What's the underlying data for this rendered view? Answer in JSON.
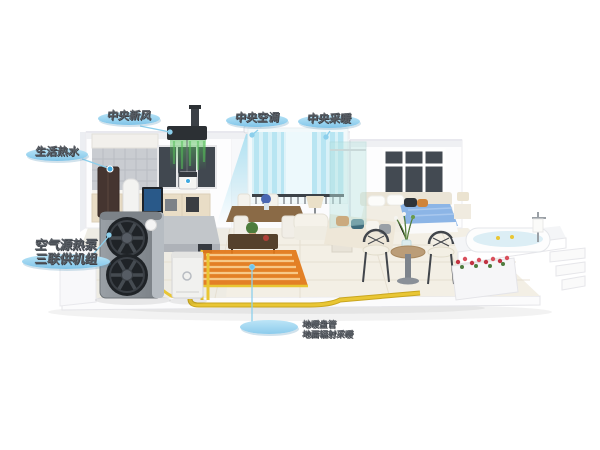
{
  "labels": {
    "fresh_air": "中央新风",
    "air_conditioning": "中央空调",
    "heating": "中央采暖",
    "hot_water": "生活热水",
    "heat_pump_line1": "空气源热泵",
    "heat_pump_line2": "三联供机组",
    "floor_heating_line1": "地暖盘管",
    "floor_heating_line2": "地面辐射采暖"
  },
  "colors": {
    "label_pill": "#92cfee",
    "label_text": "#565b62",
    "leader_line": "#8ccfec",
    "airflow_cool": "#7fd2ec",
    "airflow_fresh": "#56c05a",
    "pipe_yellow": "#e9c634",
    "floor_heating_mat": "#e2791b",
    "heat_pump_body": "#8a9096",
    "bed_blanket": "#8cb5e6",
    "flowers_red": "#c23343"
  }
}
